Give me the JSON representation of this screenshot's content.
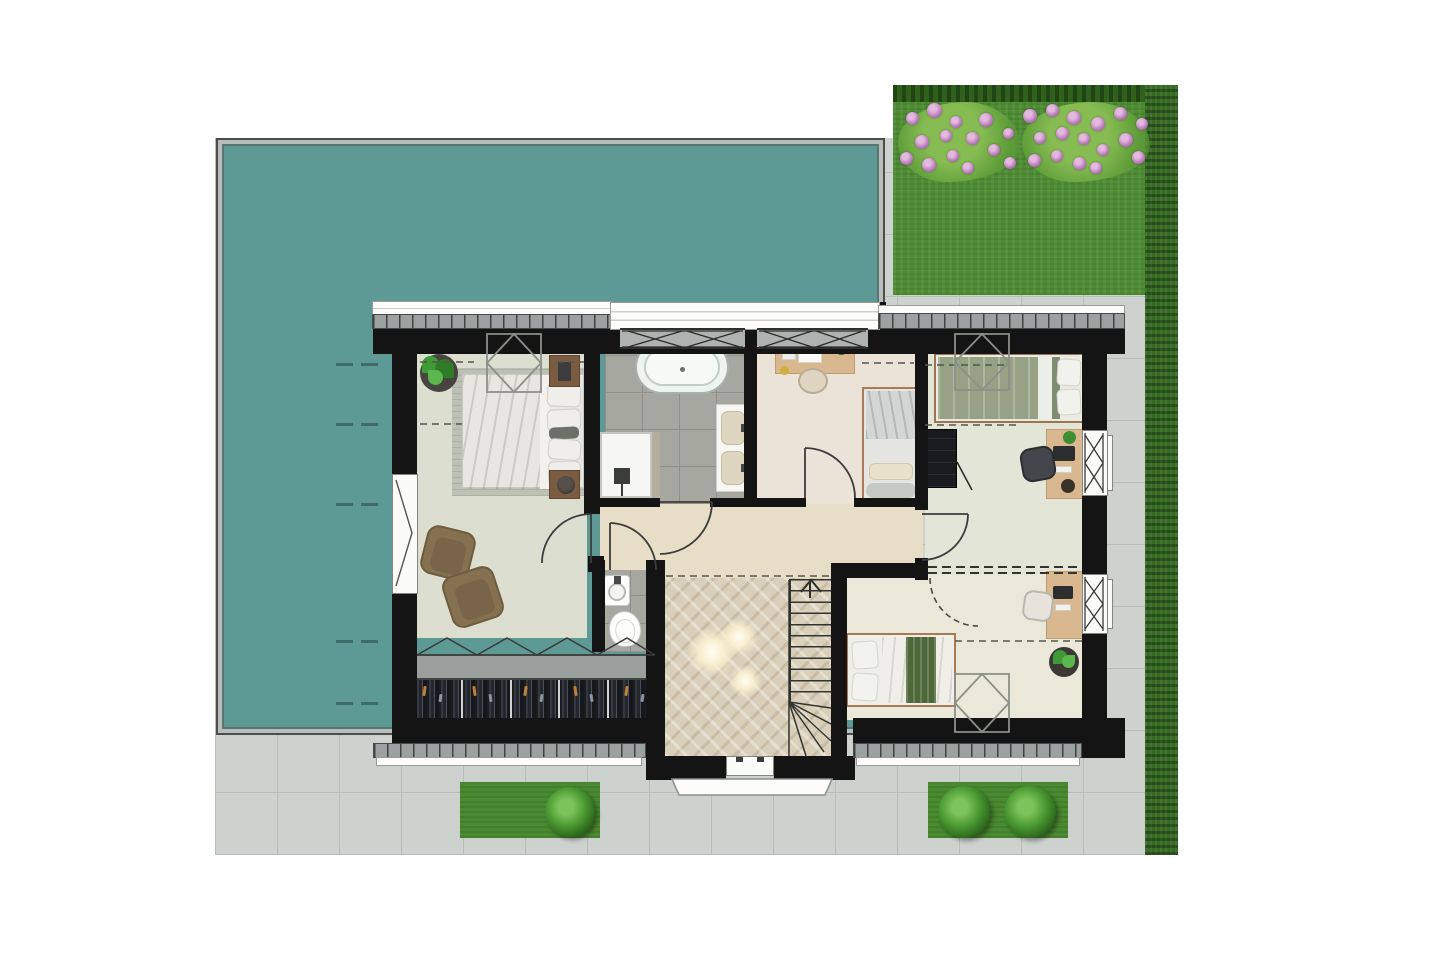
{
  "scene": {
    "type": "floor-plan-rendering",
    "view": "top-down",
    "description": "Upper floor plan of a detached house with teal flat-roof terrace at west, lawn with flower bed at north-east, paved surround, hedge at east and planting strips at south"
  },
  "palette": {
    "background": "#ffffff",
    "flat_roof_teal": "#5d9a95",
    "roof_frame_gray": "#b9bdbc",
    "lawn_green": "#4e8c33",
    "hedge_green": "#2f611c",
    "flower_pink": "#bd7cc0",
    "paving_gray": "#cdd2cf",
    "paving_joint": "#b7bdba",
    "wall_black": "#141414",
    "roof_edge_hatch": "#9ba1a0",
    "floor_master_bedroom": "#dcdfd0",
    "floor_bathroom_tile": "#a6a79e",
    "floor_study": "#ece3d8",
    "floor_bedroom_ne": "#e3e6d6",
    "floor_bedroom_se": "#eae8d9",
    "floor_hallway": "#e8dec8",
    "floor_landing_wood": "#d9cfba",
    "desk_wood": "#d9b890",
    "nightstand_wood": "#7c5c41",
    "bed_linen_white": "#e7e6e1",
    "duvet_sage_green": "#93a084",
    "throw_dark_green": "#4e6837",
    "armchair_brown": "#85714f",
    "ceiling_light_glow": "#fff3d8"
  },
  "rooms": [
    {
      "id": "master-bedroom",
      "features": [
        "double-bed",
        "rug",
        "nightstand-north",
        "nightstand-south",
        "potted-plant",
        "armchair-1",
        "armchair-2",
        "built-in-wardrobe",
        "skylight",
        "window-west"
      ]
    },
    {
      "id": "bathroom",
      "features": [
        "freestanding-bathtub",
        "walk-in-shower",
        "double-washbasin-vanity",
        "dormer-window-north"
      ]
    },
    {
      "id": "study-bedroom",
      "features": [
        "desk",
        "desk-chair",
        "single-bed",
        "dormer-window-north"
      ]
    },
    {
      "id": "bedroom-northeast",
      "features": [
        "double-bed-sage",
        "skylight",
        "black-wardrobe",
        "desk",
        "office-chair",
        "window-east"
      ]
    },
    {
      "id": "bedroom-southeast",
      "features": [
        "double-bed-white-green-throw",
        "desk",
        "desk-chair",
        "potted-plant",
        "skylight",
        "window-east"
      ]
    },
    {
      "id": "wc",
      "features": [
        "round-washbasin",
        "toilet"
      ]
    },
    {
      "id": "hallway",
      "features": [
        "door-master-bedroom",
        "door-bathroom",
        "door-study",
        "door-bedroom-northeast",
        "door-wc"
      ]
    },
    {
      "id": "landing",
      "features": [
        "staircase-with-winders",
        "up-arrow",
        "three-ceiling-lights",
        "dormer-window-south"
      ]
    }
  ],
  "counts": {
    "wardrobe_sections": 5,
    "stair_treads": 11,
    "skylights": 3,
    "dormer_window_panes": 4,
    "ceiling_lights": 3,
    "garden_bushes": 3,
    "flowerbed_flowers": 30,
    "roof_dash_rows": 5
  },
  "generated": {
    "flowers": [
      [
        912,
        118,
        13
      ],
      [
        934,
        110,
        15
      ],
      [
        956,
        122,
        12
      ],
      [
        922,
        142,
        14
      ],
      [
        946,
        136,
        12
      ],
      [
        906,
        158,
        13
      ],
      [
        929,
        165,
        14
      ],
      [
        953,
        156,
        12
      ],
      [
        972,
        138,
        13
      ],
      [
        968,
        168,
        12
      ],
      [
        986,
        120,
        14
      ],
      [
        994,
        150,
        12
      ],
      [
        1008,
        133,
        11
      ],
      [
        1010,
        163,
        12
      ],
      [
        1030,
        116,
        14
      ],
      [
        1052,
        110,
        13
      ],
      [
        1074,
        118,
        14
      ],
      [
        1040,
        138,
        12
      ],
      [
        1062,
        133,
        13
      ],
      [
        1084,
        139,
        12
      ],
      [
        1034,
        160,
        13
      ],
      [
        1057,
        156,
        12
      ],
      [
        1079,
        163,
        13
      ],
      [
        1098,
        124,
        14
      ],
      [
        1103,
        150,
        12
      ],
      [
        1096,
        168,
        12
      ],
      [
        1120,
        113,
        13
      ],
      [
        1126,
        140,
        14
      ],
      [
        1142,
        124,
        12
      ],
      [
        1138,
        157,
        13
      ]
    ],
    "roof_dashes": [
      363,
      423,
      503,
      640,
      702
    ],
    "lights": [
      [
        712,
        652,
        52
      ],
      [
        739,
        637,
        40
      ],
      [
        745,
        681,
        34
      ]
    ],
    "bushes": [
      [
        545,
        787,
        50
      ],
      [
        938,
        786,
        52
      ],
      [
        1004,
        786,
        52
      ]
    ],
    "clothes_fleck_colors": [
      "#c08038",
      "#8d93a1"
    ]
  }
}
